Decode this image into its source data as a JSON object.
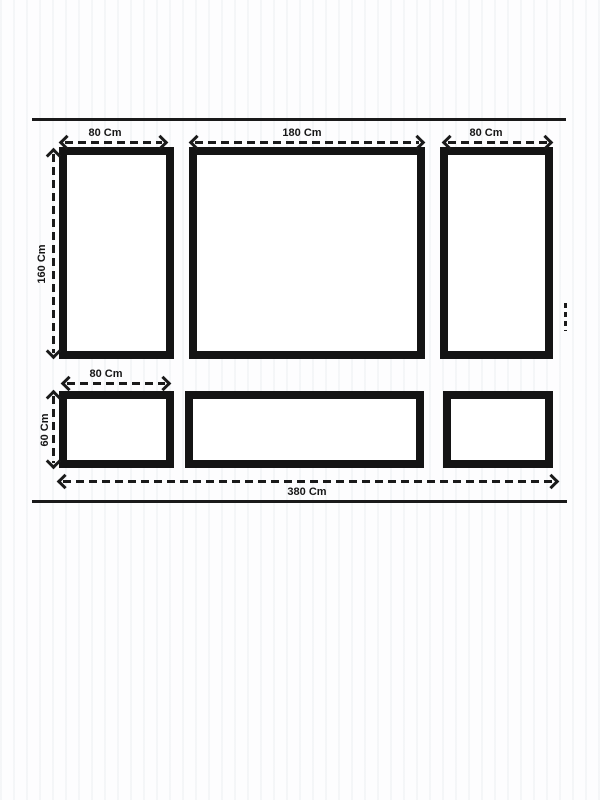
{
  "diagram": {
    "type": "panel-dimension-drawing",
    "colors": {
      "line": "#1a1a1a",
      "background": "#fdfdfe"
    },
    "dimensions": {
      "top_left_width": "80 Cm",
      "top_middle_width": "180 Cm",
      "top_right_width": "80 Cm",
      "top_row_height": "160 Cm",
      "bottom_left_width": "80 Cm",
      "bottom_row_height": "60 Cm",
      "total_width": "380 Cm"
    }
  }
}
